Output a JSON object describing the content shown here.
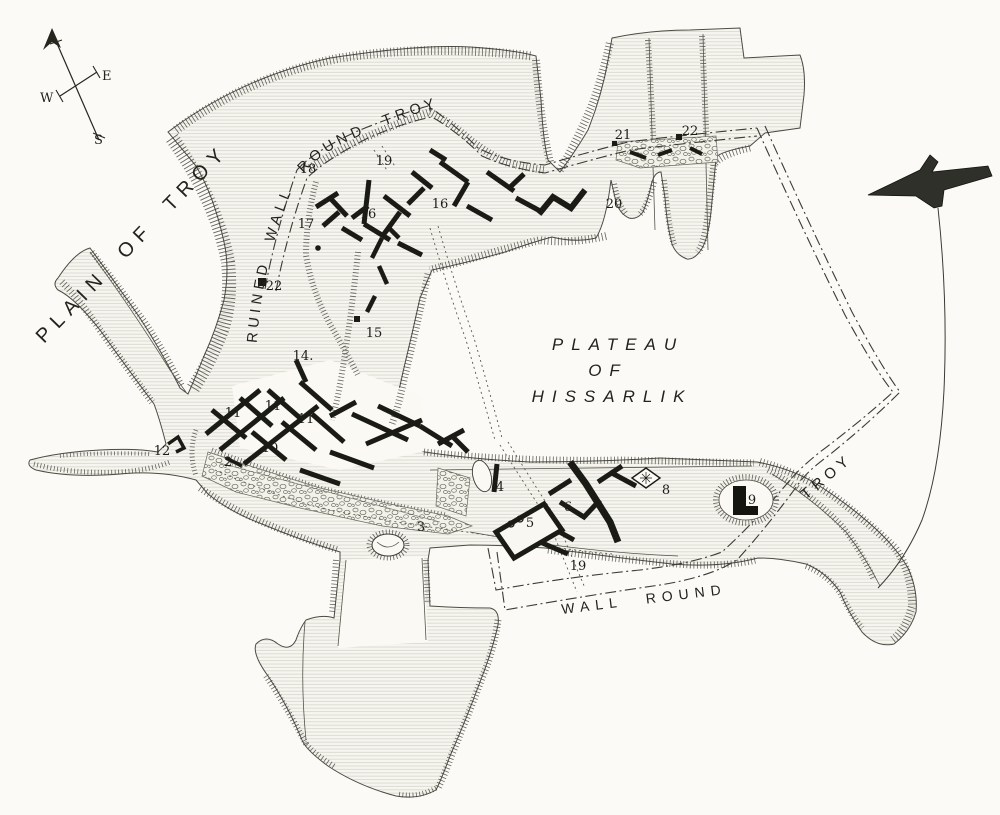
{
  "map": {
    "region_labels": {
      "plain_of_troy": "PLAIN OF TROY",
      "ruined_wall_round_troy": "RUINED WALL ROUND TROY",
      "plateau_of_hissarlik": [
        "PLATEAU",
        "OF",
        "HISSARLIK"
      ],
      "wall_round": "WALL ROUND",
      "troy_right": "TROY"
    },
    "compass": {
      "east": "E",
      "west": "W",
      "south": "S"
    },
    "site_numbers": [
      {
        "label": "18"
      },
      {
        "label": "19"
      },
      {
        "label": "17"
      },
      {
        "label": "16"
      },
      {
        "label": "16"
      },
      {
        "label": "20"
      },
      {
        "label": "21"
      },
      {
        "label": "22"
      },
      {
        "label": "22"
      },
      {
        "label": "15"
      },
      {
        "label": "14."
      },
      {
        "label": "11"
      },
      {
        "label": "11"
      },
      {
        "label": "11"
      },
      {
        "label": "10"
      },
      {
        "label": "12"
      },
      {
        "label": "2"
      },
      {
        "label": "3"
      },
      {
        "label": "4"
      },
      {
        "label": "5"
      },
      {
        "label": "6"
      },
      {
        "label": "19"
      },
      {
        "label": "8"
      },
      {
        "label": "9"
      }
    ],
    "colors": {
      "paper": "#fbfaf6",
      "ink": "#26261f",
      "ruin_wall": "#1b1b16",
      "hachure": "#3f3e37"
    }
  }
}
